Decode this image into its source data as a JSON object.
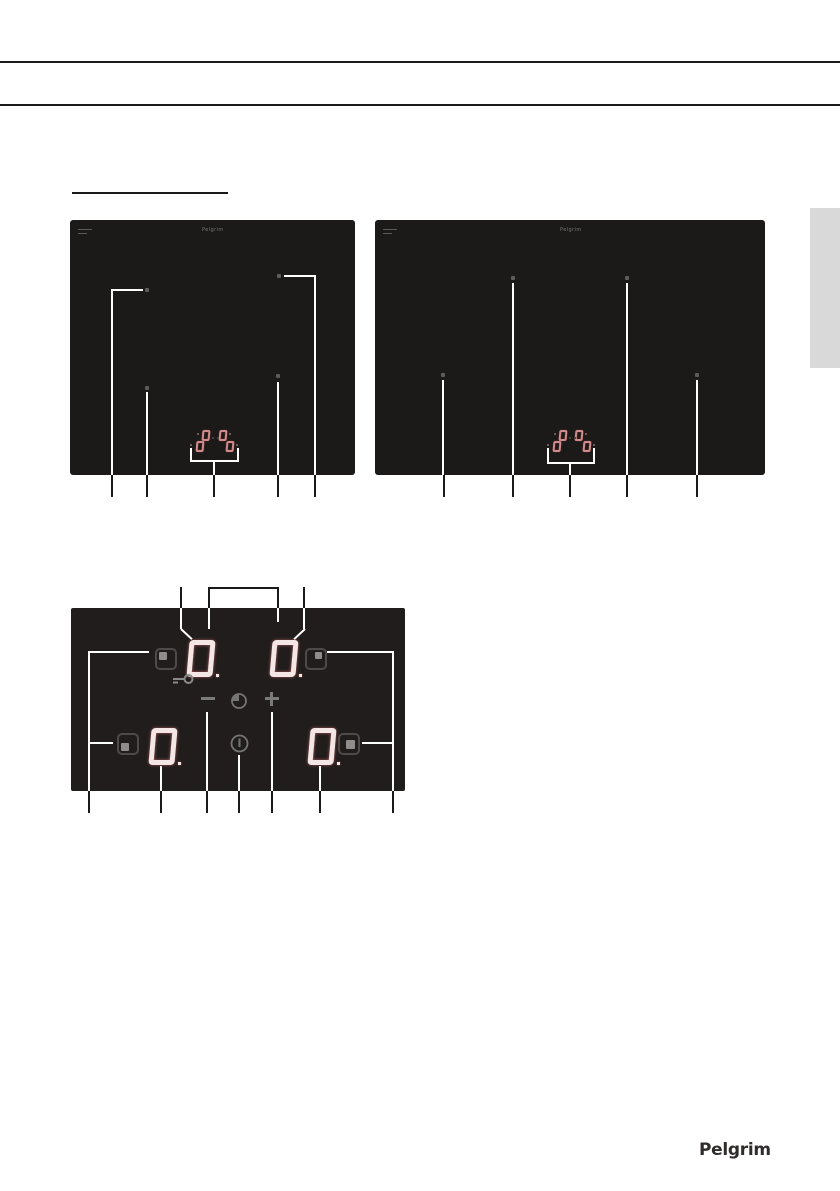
{
  "colors": {
    "rule": "#1a1a1a",
    "callout-black": "#1a1a1a",
    "callout-white": "#ffffff",
    "hob-bg": "#1c1a19",
    "panel-bg": "#201d1c",
    "digit": "#f3e6e4",
    "mini-digit": "#cf8c8c",
    "icon-gray": "#7a7a7a",
    "key-outline": "#4e4a4a",
    "key-inner": "#918c8c",
    "side-tab": "#d9d9d9",
    "hob-label": "#787674",
    "logo": "#2f2c2c"
  },
  "hob_left": {
    "brand": "Pelgrim",
    "zones": 4,
    "display_digits": [
      "0",
      "0",
      "0",
      "0"
    ]
  },
  "hob_right": {
    "brand": "Pelgrim",
    "zones": 4,
    "display_digits": [
      "0",
      "0",
      "0",
      "0"
    ]
  },
  "control_panel": {
    "digits": {
      "back_left": "0",
      "back_right": "0",
      "front_left": "0",
      "front_right": "0"
    },
    "key_icons": [
      "zone-select-back-left",
      "zone-select-back-right",
      "zone-select-front-left",
      "zone-select-front-right",
      "minus-key",
      "timer-key",
      "plus-key",
      "power-key",
      "child-lock-indicator"
    ]
  },
  "footer": {
    "brand_logo": "Pelgrim"
  }
}
